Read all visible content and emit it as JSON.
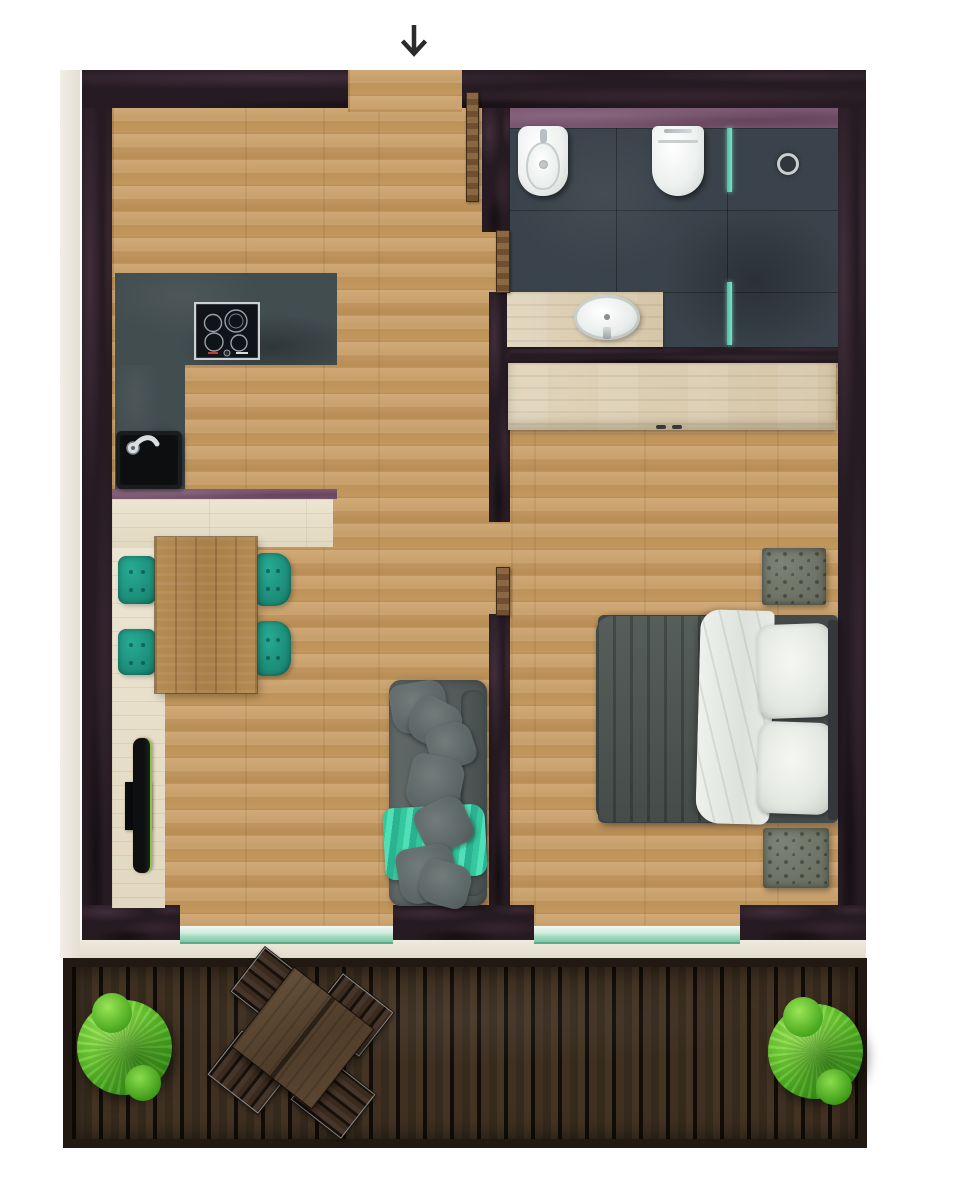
{
  "meta": {
    "view": "apartment-floor-plan-top-view",
    "orientation": "entrance-at-top"
  },
  "indicator": {
    "entrance_arrow": "Entrance direction arrow"
  },
  "palette": {
    "background": "#ffffff",
    "wall_dark": "#2a1e26",
    "wall_accent_purple": "#7b5671",
    "wood_floor": "#c7a069",
    "pale_wood": "#e6decb",
    "kitchen_counter": "#424d50",
    "bathroom_tile": "#3a434b",
    "teal_chair": "#1d8a78",
    "turquoise_throw": "#3fd1aa",
    "sofa_grey": "#5a6261",
    "deck_wood": "#35281c",
    "plant_green": "#55b62a",
    "porcelain": "#f2f5f3",
    "glass_teal": "#8fd4b8",
    "arrow_black": "#2b2b2b"
  },
  "rooms": {
    "hallway": {
      "label": "Entrance hallway"
    },
    "kitchen": {
      "label": "Kitchen"
    },
    "bathroom": {
      "label": "Bathroom"
    },
    "living_dining": {
      "label": "Living and dining room"
    },
    "bedroom": {
      "label": "Bedroom"
    },
    "balcony": {
      "label": "Balcony terrace"
    }
  },
  "furniture": {
    "kitchen_counter": {
      "label": "L-shaped kitchen counter"
    },
    "hob": {
      "label": "Cooktop with four burners"
    },
    "kitchen_sink": {
      "label": "Kitchen sink with faucet"
    },
    "kitchen_low_wall": {
      "label": "Kitchen plinth wall"
    },
    "dining_table": {
      "label": "Rustic wooden dining table"
    },
    "dining_chair": {
      "label": "Teal upholstered dining chair"
    },
    "tv": {
      "label": "Wall-mounted TV"
    },
    "tv_mount": {
      "label": "TV mount"
    },
    "sofa": {
      "label": "Grey fabric sofa"
    },
    "sofa_throw": {
      "label": "Turquoise throw blanket"
    },
    "sofa_pillow": {
      "label": "Sofa cushion"
    },
    "bed": {
      "label": "Double bed"
    },
    "bed_duvet": {
      "label": "Grey duvet"
    },
    "bed_sheet": {
      "label": "White top sheet"
    },
    "bed_pillow": {
      "label": "White bed pillow"
    },
    "headboard": {
      "label": "Bed headboard"
    },
    "wardrobe": {
      "label": "Wardrobe"
    },
    "ottoman": {
      "label": "Tufted ottoman"
    },
    "bidet": {
      "label": "Bidet"
    },
    "toilet": {
      "label": "Wall-hung toilet"
    },
    "shower_glass": {
      "label": "Walk-in shower glass partition"
    },
    "shower_drain": {
      "label": "Shower drain"
    },
    "vanity": {
      "label": "Washbasin vanity counter"
    },
    "washbasin": {
      "label": "Oval countertop washbasin"
    },
    "entry_door": {
      "label": "Open entrance door leaf"
    },
    "bathroom_door": {
      "label": "Open bathroom door leaf"
    },
    "bedroom_door": {
      "label": "Open bedroom door leaf"
    },
    "glass_balcony_door": {
      "label": "Glass balcony door"
    },
    "balcony_deck": {
      "label": "Wooden balcony decking"
    },
    "balcony_table": {
      "label": "Square outdoor table"
    },
    "balcony_chair": {
      "label": "Slatted outdoor chair"
    },
    "plant": {
      "label": "Round green shrub"
    }
  }
}
